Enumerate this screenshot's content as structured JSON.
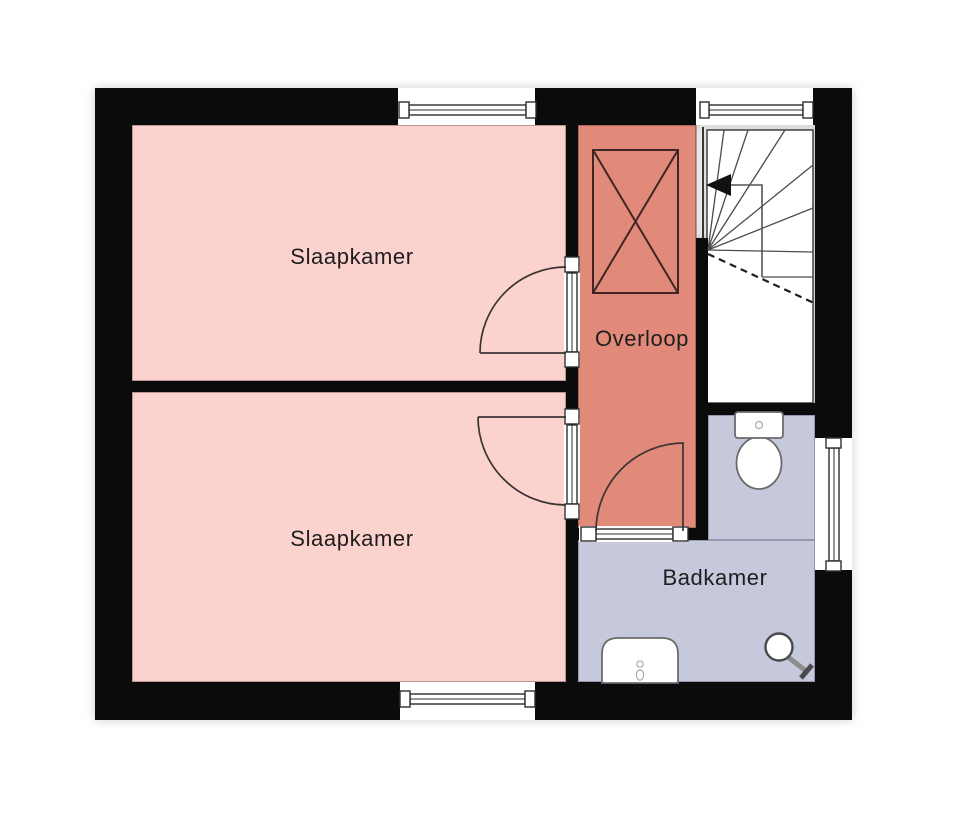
{
  "plan": {
    "type": "floor-plan",
    "floor": "upper-floor"
  },
  "rooms": {
    "bedroom_top": {
      "label": "Slaapkamer"
    },
    "bedroom_bottom": {
      "label": "Slaapkamer"
    },
    "landing": {
      "label": "Overloop"
    },
    "bathroom": {
      "label": "Badkamer"
    }
  },
  "colors": {
    "wall": "#0b0b0b",
    "bedroom": "#fbd2cd",
    "landing": "#e28a7a",
    "bathroom": "#c6c8db",
    "line": "#3a3434",
    "room_outline": "rgba(60,30,30,0.45)",
    "label_text": "#1e1e1e",
    "fixture_stroke": "#6b6b6b"
  },
  "icons": {
    "closet": "crossed-rectangle-closet",
    "stairs": "winder-staircase",
    "stairs_arrow": "up-direction-arrow",
    "toilet": "toilet-top-view",
    "sink": "washbasin-top-view",
    "shower": "shower-head-top-view",
    "windows": "double-line-window",
    "doors": "quarter-swing-door"
  }
}
